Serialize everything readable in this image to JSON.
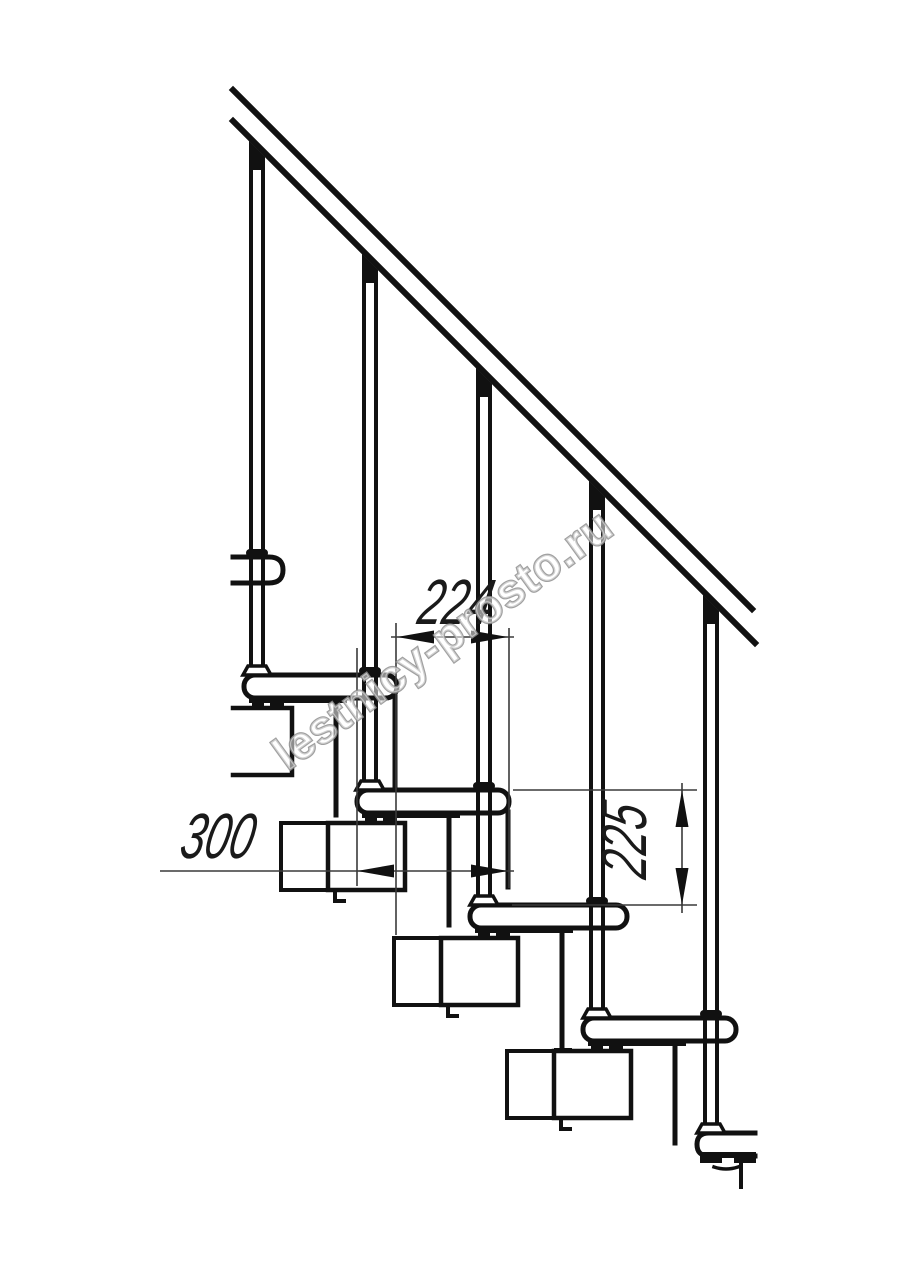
{
  "drawing": {
    "type": "staircase-side-elevation",
    "background": "#ffffff",
    "line_color": "#111111",
    "thin_line_color": "#3a3a3a"
  },
  "dimensions": {
    "step_run": "224",
    "tread_depth": "300",
    "step_rise": "225"
  },
  "watermark": {
    "text": "lestnicy-prosto.ru"
  }
}
